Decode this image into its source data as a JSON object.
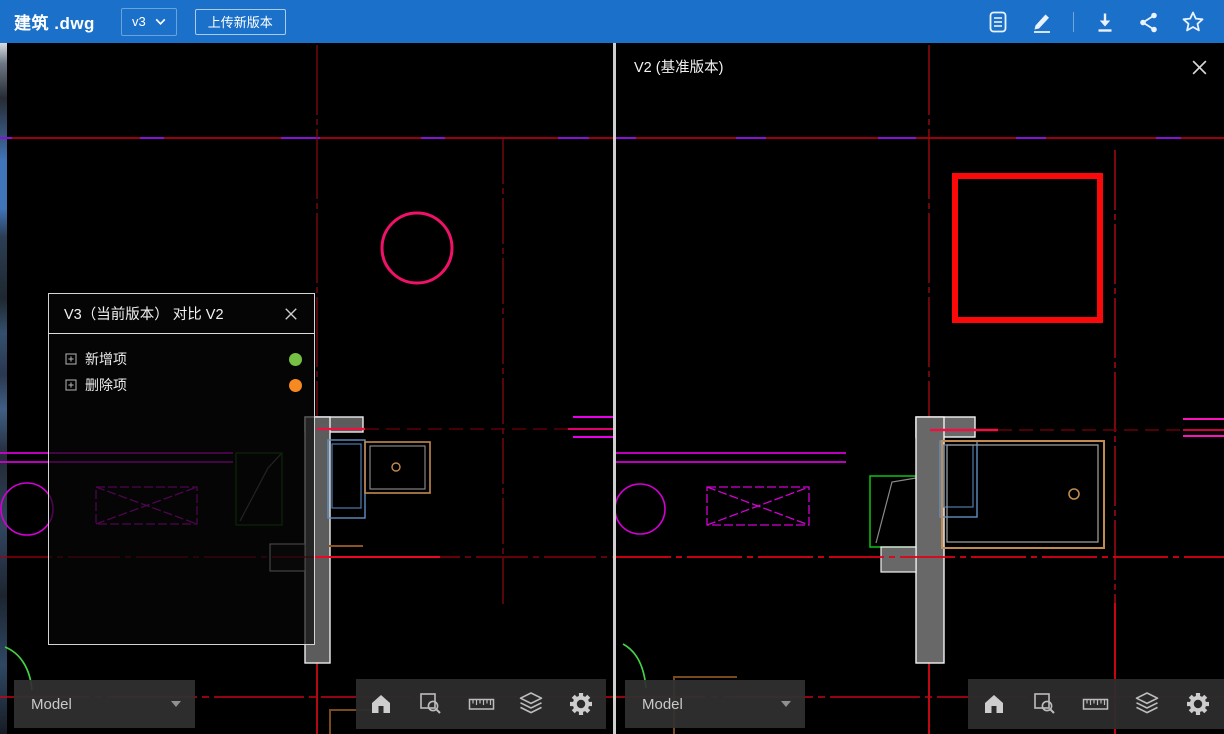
{
  "header": {
    "title": "建筑 .dwg",
    "version": "v3",
    "upload_label": "上传新版本",
    "action_icons": [
      "document",
      "annotate-pen",
      "download",
      "share",
      "favorite-star"
    ]
  },
  "compare_panel": {
    "title": "V3（当前版本） 对比 V2",
    "items": [
      {
        "label": "新增项",
        "color": "#76c043"
      },
      {
        "label": "删除项",
        "color": "#f6891f"
      }
    ]
  },
  "left_view": {
    "sheet_label": "Model"
  },
  "right_view": {
    "label": "V2 (基准版本)",
    "sheet_label": "Model"
  },
  "bottom_toolbar_icons": [
    "home",
    "zoom-window",
    "measure-ruler",
    "layers",
    "settings-gear"
  ],
  "colors": {
    "header_bg": "#1b70c9",
    "canvas_bg": "#000000",
    "added_marker_dot": "#76c043",
    "removed_marker_dot": "#f6891f",
    "centerline_red": "#cf0016",
    "centerline_purple": "#8a10d8",
    "added_circle_highlight": "#f01168",
    "removed_box_highlight": "#fb0909",
    "cad_magenta": "#d400d4",
    "cad_tan": "#c08a50",
    "cad_blue": "#6090c2",
    "cad_green": "#0ec40e",
    "wall_gray": "#686868"
  }
}
